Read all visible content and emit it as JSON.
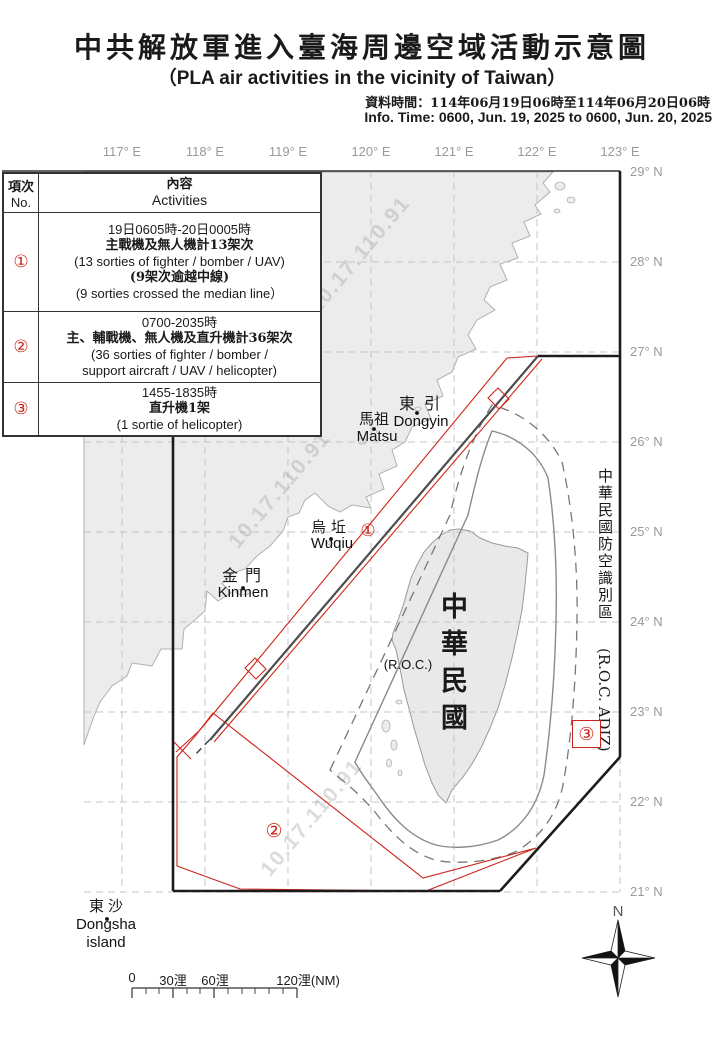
{
  "header": {
    "title": "中共解放軍進入臺海周邊空域活動示意圖",
    "subtitle": "（PLA air activities in the vicinity of Taiwan）",
    "info_zh": "資料時間：114年06月19日06時至114年06月20日06時",
    "info_en": "Info. Time: 0600, Jun. 19, 2025 to 0600, Jun. 20, 2025"
  },
  "axes": {
    "lon": [
      "117° E",
      "118° E",
      "119° E",
      "120° E",
      "121° E",
      "122° E",
      "123° E"
    ],
    "lat": [
      "29° N",
      "28° N",
      "27° N",
      "26° N",
      "25° N",
      "24° N",
      "23° N",
      "22° N",
      "21° N"
    ]
  },
  "table": {
    "header": {
      "no_zh": "項次",
      "no_en": "No.",
      "act_zh": "內容",
      "act_en": "Activities"
    },
    "rows": [
      {
        "num": "①",
        "lines": [
          "19日0605時-20日0005時",
          "主戰機及無人機計13架次",
          "(13 sorties of fighter / bomber / UAV)",
          "(9架次逾越中線)",
          "(9 sorties crossed the median line）"
        ]
      },
      {
        "num": "②",
        "lines": [
          "0700-2035時",
          "主、輔戰機、無人機及直升機計36架次",
          "(36 sorties of fighter / bomber /",
          "support aircraft / UAV / helicopter)"
        ]
      },
      {
        "num": "③",
        "lines": [
          "1455-1835時",
          "直升機1架",
          "(1 sortie of helicopter)"
        ]
      }
    ]
  },
  "map": {
    "labels": {
      "dongyin_zh": "東引",
      "dongyin_en": "Dongyin",
      "matsu_zh": "馬祖",
      "matsu_en": "Matsu",
      "wuqiu_zh": "烏坵",
      "wuqiu_en": "Wuqiu",
      "kinmen_zh": "金門",
      "kinmen_en": "Kinmen",
      "dongsha_zh": "東沙",
      "dongsha_en1": "Dongsha",
      "dongsha_en2": "island",
      "roc_zh": "中華民國",
      "roc_en": "(R.O.C.)",
      "adiz_zh": "中華民國防空識別區",
      "adiz_en": "(R.O.C. ADIZ)"
    },
    "markers": {
      "a1": "①",
      "a2": "②",
      "a3": "③"
    },
    "compass_n": "N",
    "watermark": "10.17.110.91"
  },
  "scalebar": {
    "t0": "0",
    "t30": "30浬",
    "t60": "60浬",
    "t120": "120浬(NM)"
  },
  "colors": {
    "accent_red": "#cc2418",
    "land": "#ececec",
    "grid": "#c4c4c4",
    "boundary": "#1c1c1c",
    "median": "#4d4d4d"
  }
}
